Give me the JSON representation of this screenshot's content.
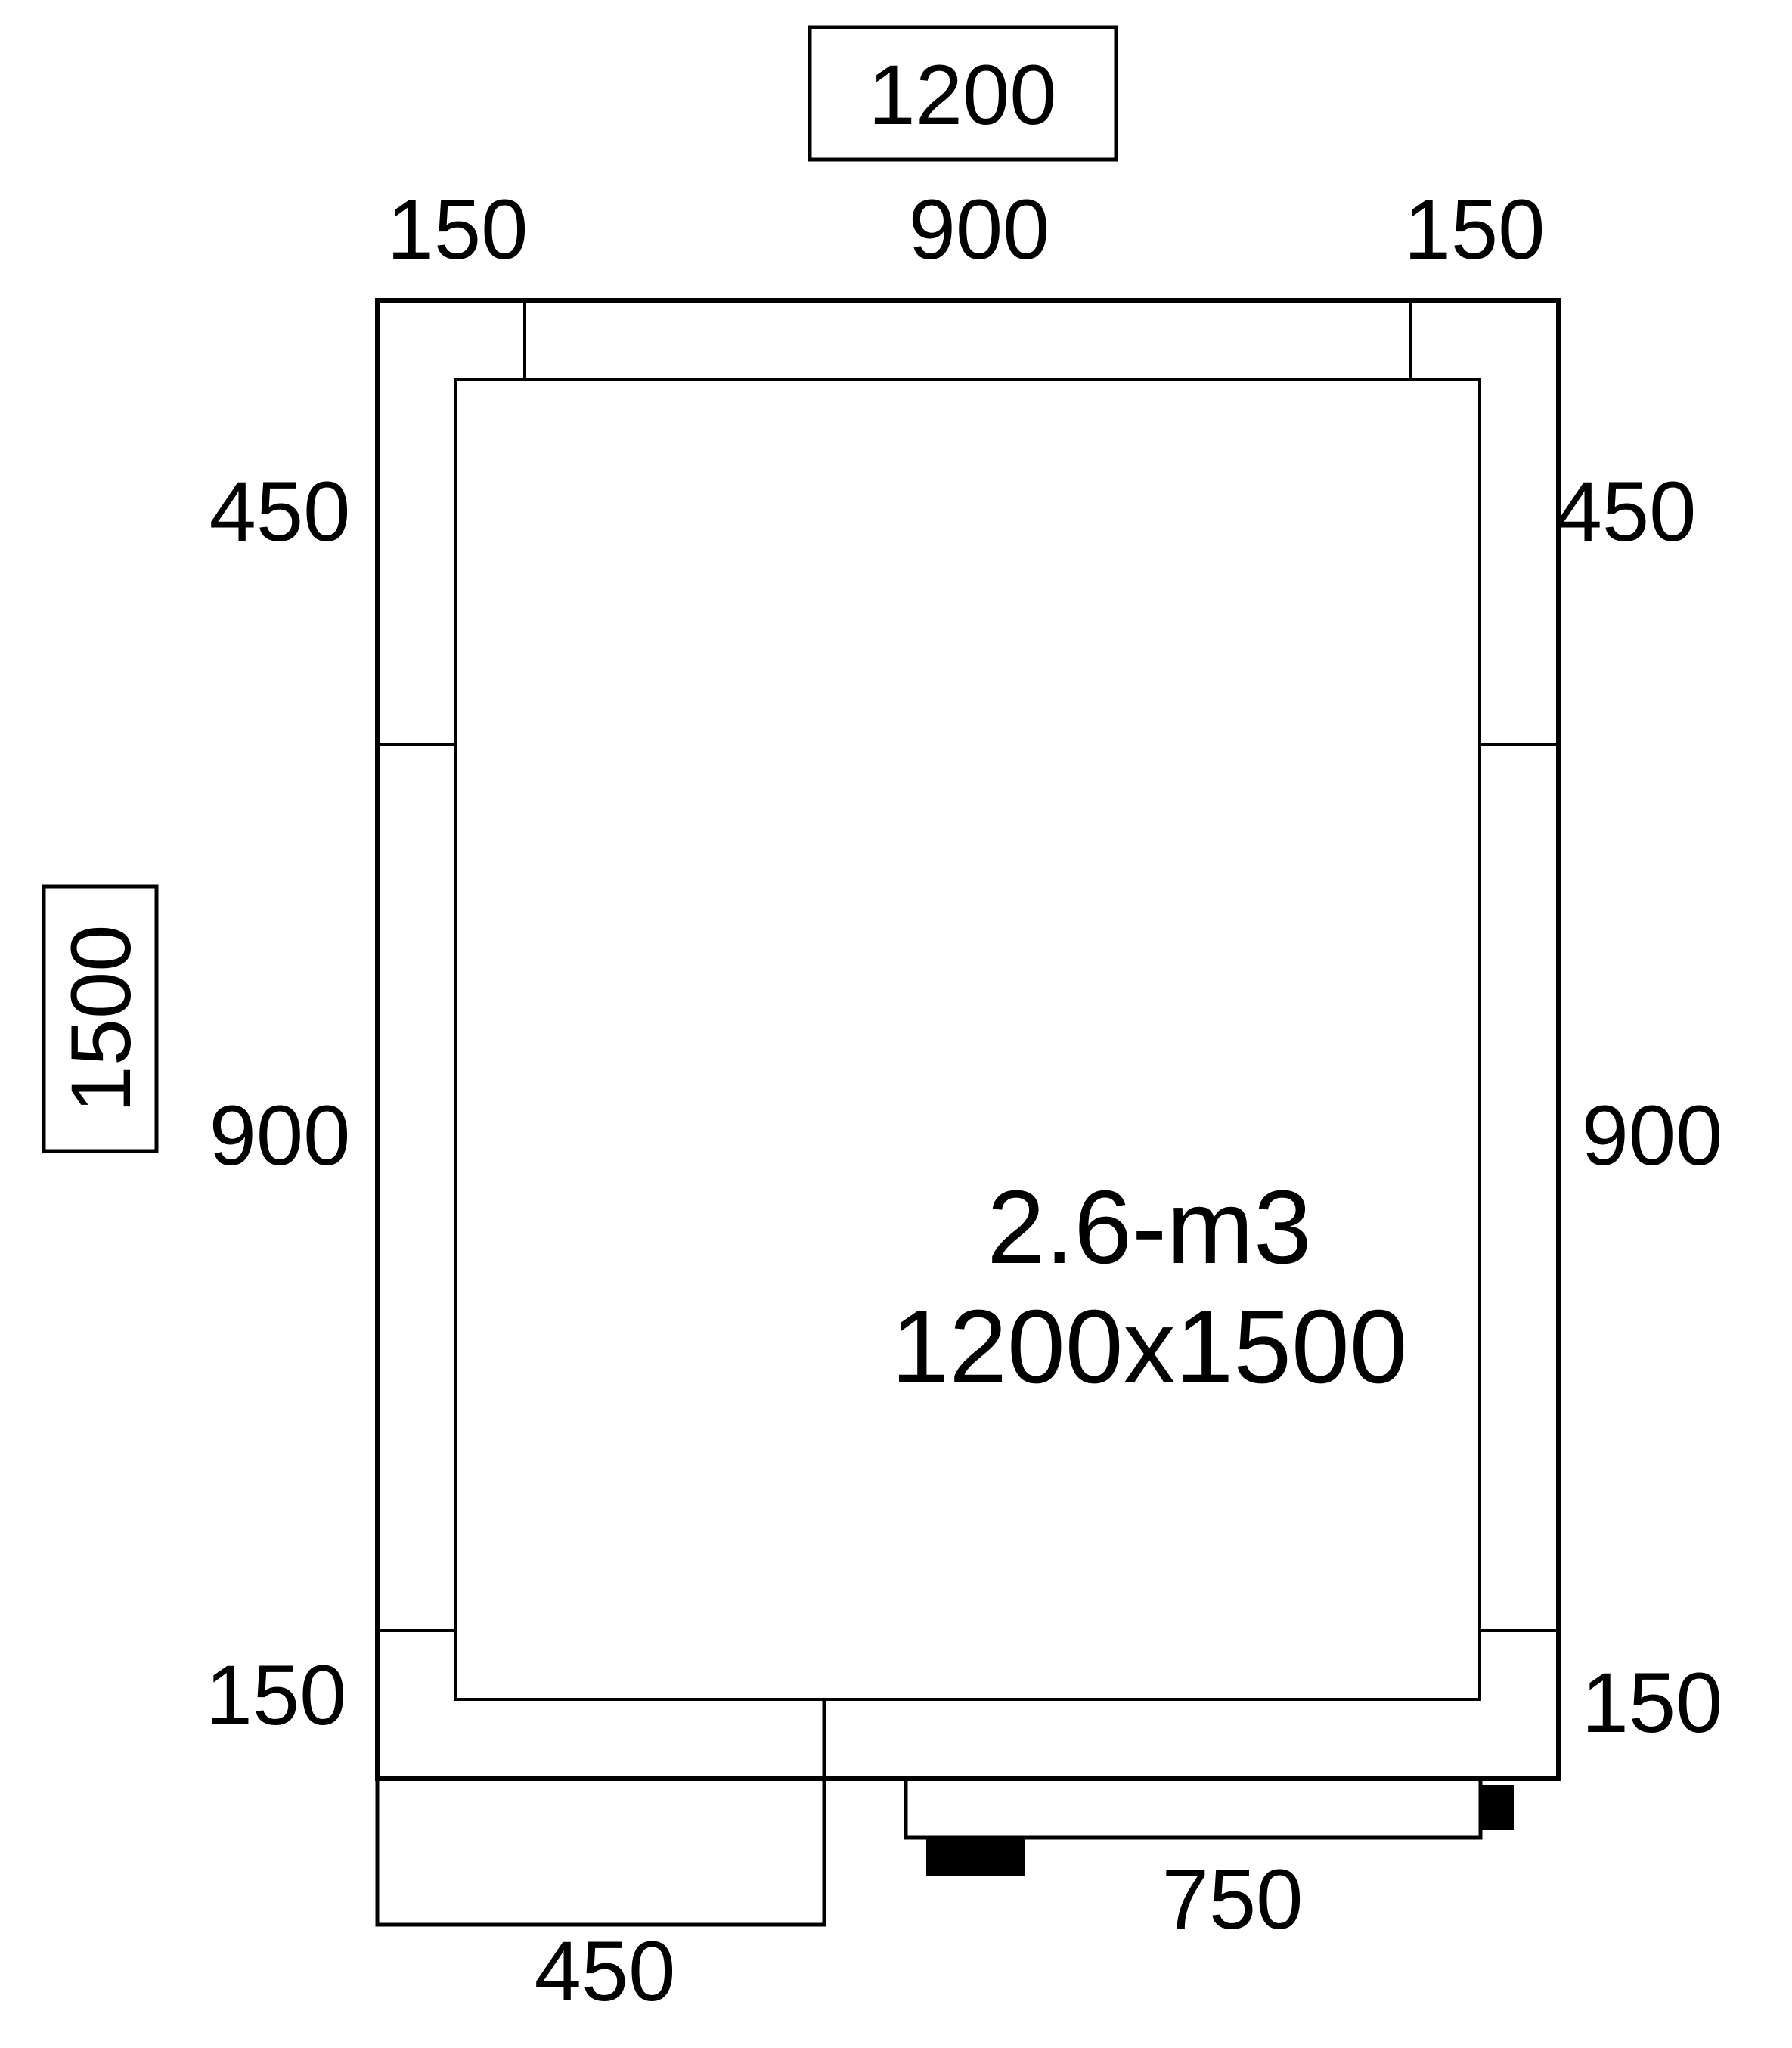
{
  "drawing": {
    "type": "cold-room floor plan, dimensioned technical drawing",
    "colors": {
      "line": "#000000",
      "background": "#ffffff",
      "solid_block": "#000000"
    },
    "overall": {
      "width_boxed": "1200",
      "height_boxed": "1500"
    },
    "top_edge": {
      "left": "150",
      "center": "900",
      "right": "150"
    },
    "left_edge": {
      "top": "450",
      "middle": "900",
      "bottom": "150"
    },
    "right_edge": {
      "top": "450",
      "middle": "900",
      "bottom": "150"
    },
    "bottom_edge": {
      "door_width": "750",
      "panel_width": "450"
    },
    "room_text": {
      "volume": "2.6-m3",
      "dimensions": "1200x1500"
    }
  }
}
